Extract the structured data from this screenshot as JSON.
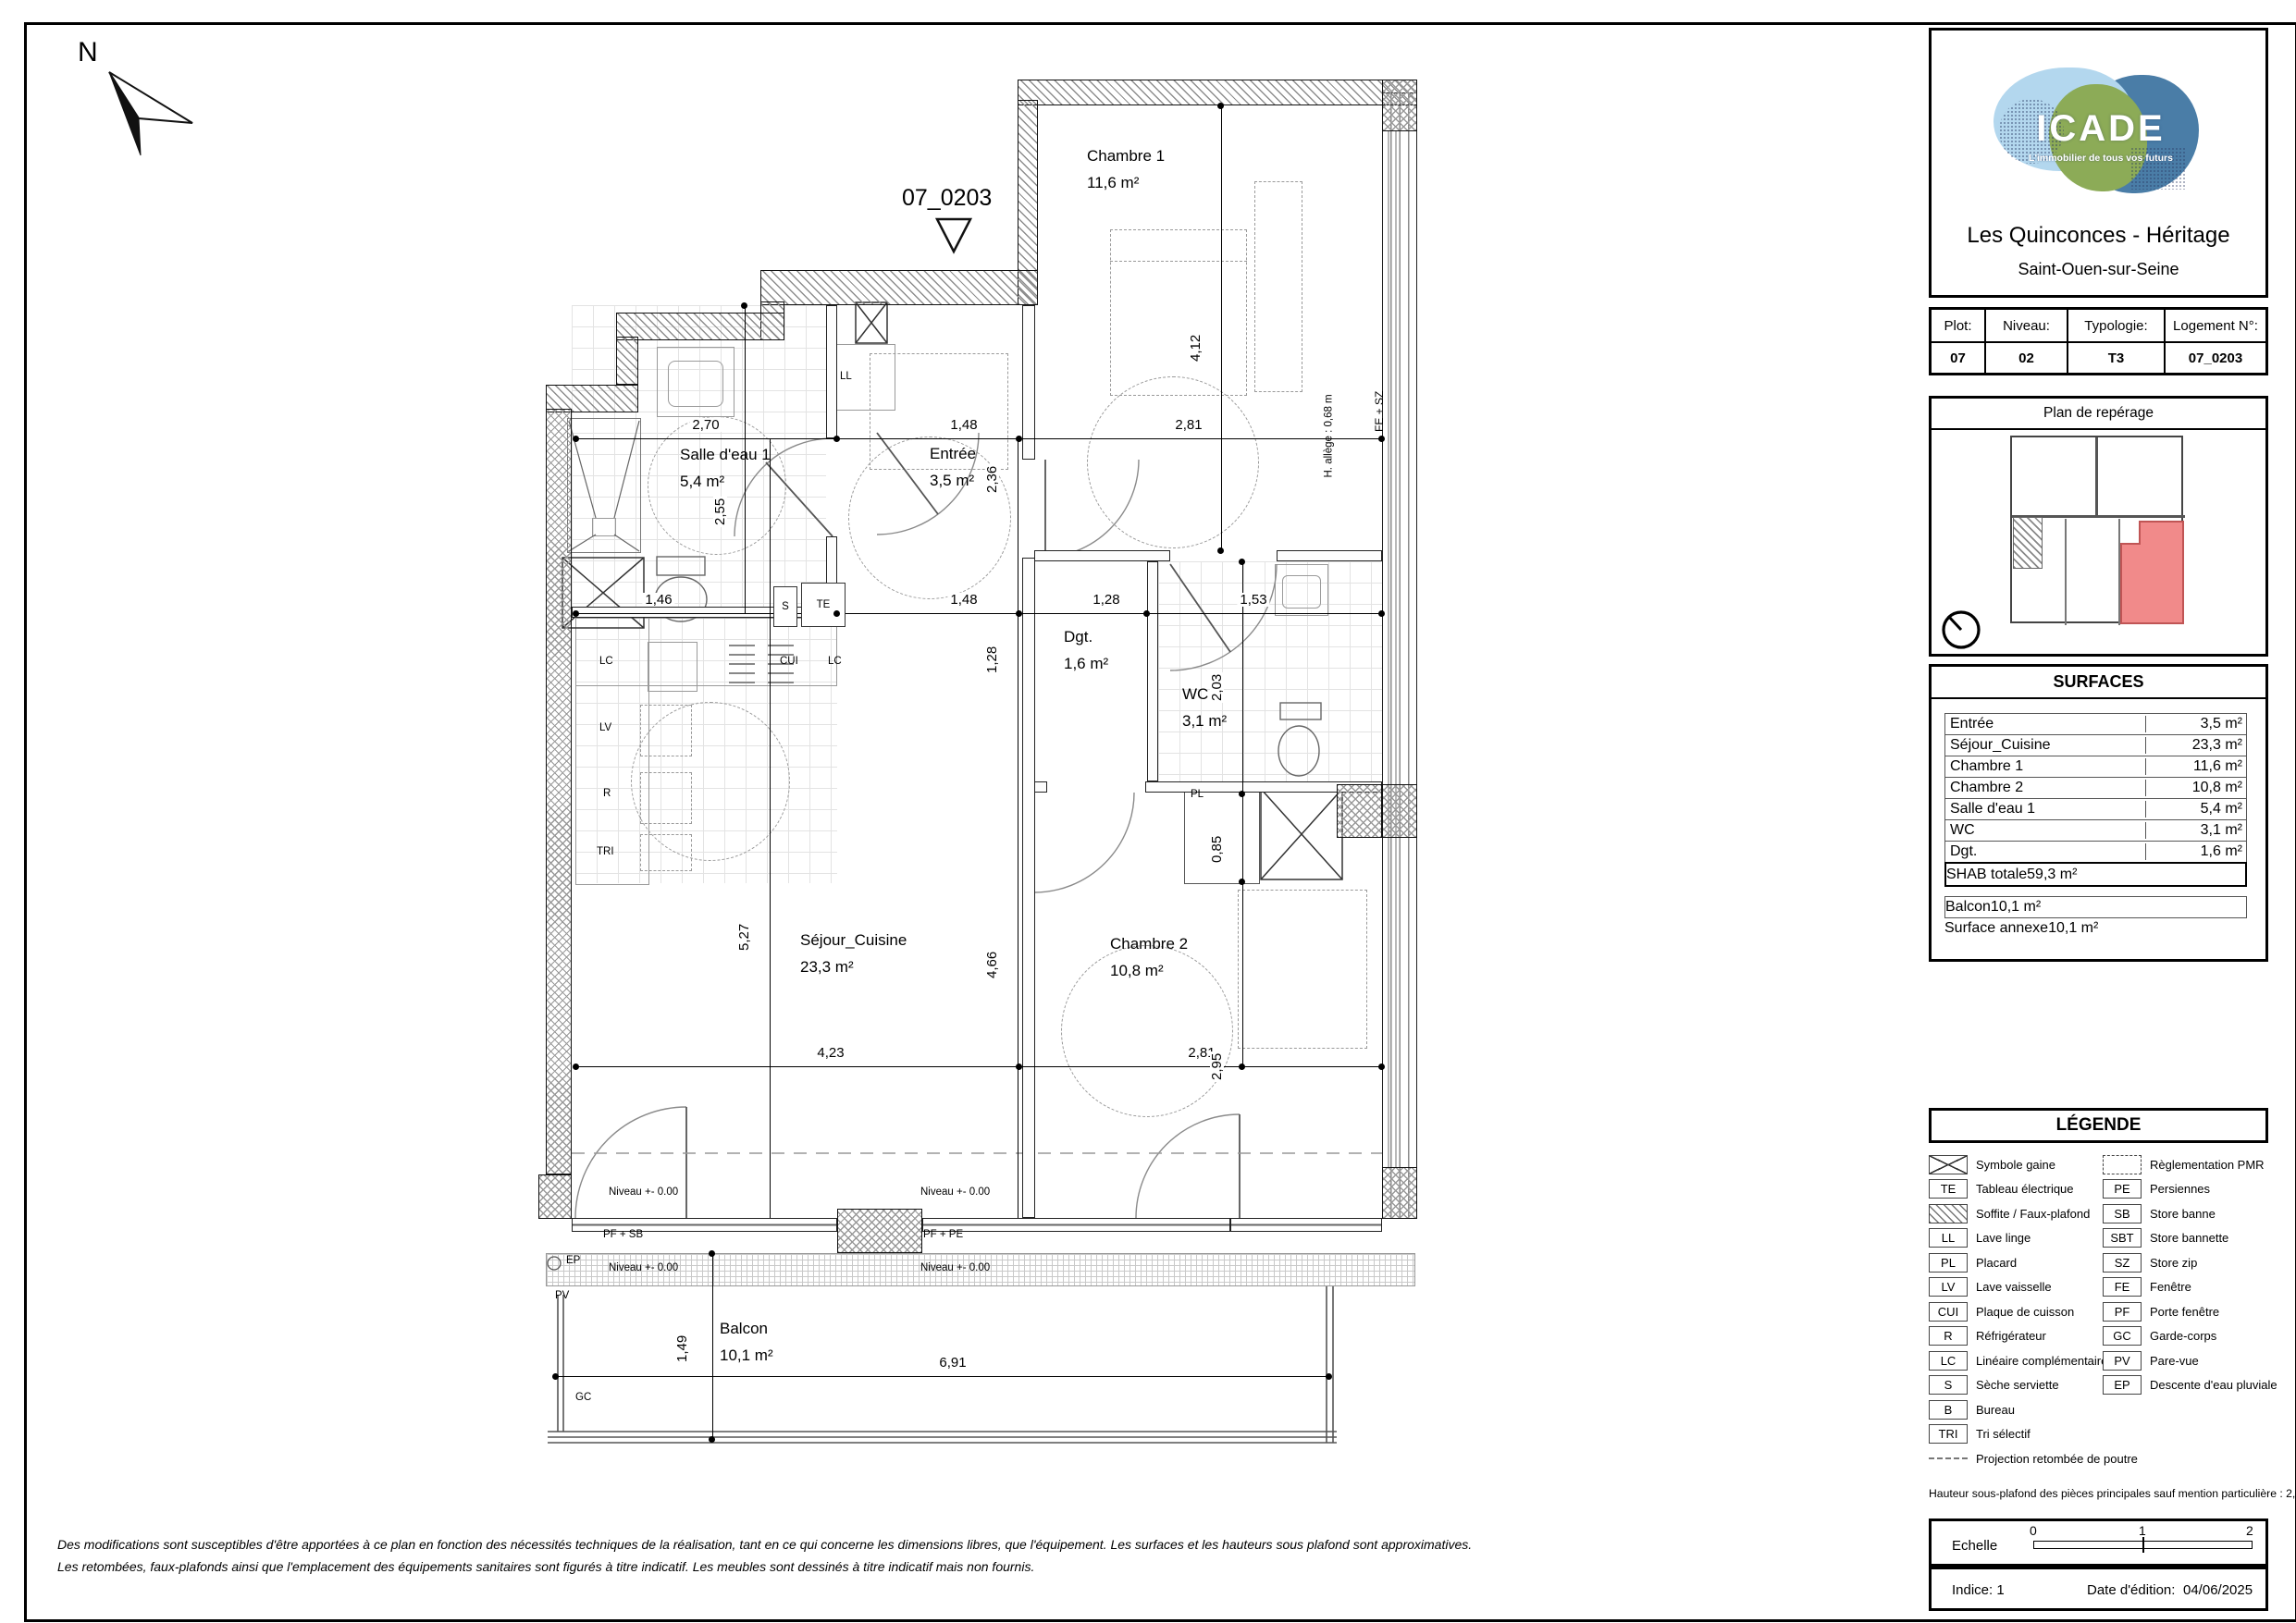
{
  "page": {
    "north_letter": "N",
    "unit_marker": "07_0203",
    "disclaimer_line1": "Des modifications sont susceptibles d'être apportées à ce plan en fonction des nécessités techniques de la réalisation, tant en ce qui concerne les dimensions libres, que l'équipement. Les surfaces et les hauteurs sous plafond sont approximatives.",
    "disclaimer_line2": "Les retombées, faux-plafonds ainsi que l'emplacement des équipements sanitaires sont figurés à titre indicatif. Les meubles sont dessinés à titre indicatif mais non fournis."
  },
  "header": {
    "brand": "ICADE",
    "tagline": "L'immobilier de tous vos futurs",
    "project_title": "Les Quinconces - Héritage",
    "city": "Saint-Ouen-sur-Seine"
  },
  "unit_info": {
    "plot_label": "Plot:",
    "plot_value": "07",
    "level_label": "Niveau:",
    "level_value": "02",
    "type_label": "Typologie:",
    "type_value": "T3",
    "lot_label": "Logement N°:",
    "lot_value": "07_0203"
  },
  "reperage": {
    "title": "Plan de repérage",
    "highlight_color": "#f18a8a"
  },
  "surfaces": {
    "title": "SURFACES",
    "rows": [
      {
        "label": "Entrée",
        "value": "3,5 m²"
      },
      {
        "label": "Séjour_Cuisine",
        "value": "23,3 m²"
      },
      {
        "label": "Chambre 1",
        "value": "11,6 m²"
      },
      {
        "label": "Chambre 2",
        "value": "10,8 m²"
      },
      {
        "label": "Salle d'eau 1",
        "value": "5,4 m²"
      },
      {
        "label": "WC",
        "value": "3,1 m²"
      },
      {
        "label": "Dgt.",
        "value": "1,6 m²"
      }
    ],
    "total": {
      "label": "SHAB totale",
      "value": "59,3 m²"
    },
    "annex_rows": [
      {
        "label": "Balcon",
        "value": "10,1 m²"
      },
      {
        "label": "Surface annexe",
        "value": "10,1 m²"
      }
    ]
  },
  "legend": {
    "title": "LÉGENDE",
    "left": [
      {
        "code": "",
        "label": "Symbole gaine"
      },
      {
        "code": "TE",
        "label": "Tableau électrique"
      },
      {
        "code": "",
        "label": "Soffite / Faux-plafond"
      },
      {
        "code": "LL",
        "label": "Lave linge"
      },
      {
        "code": "PL",
        "label": "Placard"
      },
      {
        "code": "LV",
        "label": "Lave vaisselle"
      },
      {
        "code": "CUI",
        "label": "Plaque de cuisson"
      },
      {
        "code": "R",
        "label": "Réfrigérateur"
      },
      {
        "code": "LC",
        "label": "Linéaire complémentaire"
      },
      {
        "code": "S",
        "label": "Sèche serviette"
      },
      {
        "code": "B",
        "label": "Bureau"
      },
      {
        "code": "TRI",
        "label": "Tri sélectif"
      }
    ],
    "beam_label": "Projection retombée de poutre",
    "right": [
      {
        "code": "",
        "label": "Règlementation PMR"
      },
      {
        "code": "PE",
        "label": "Persiennes"
      },
      {
        "code": "SB",
        "label": "Store banne"
      },
      {
        "code": "SBT",
        "label": "Store bannette"
      },
      {
        "code": "SZ",
        "label": "Store zip"
      },
      {
        "code": "FE",
        "label": "Fenêtre"
      },
      {
        "code": "PF",
        "label": "Porte fenêtre"
      },
      {
        "code": "GC",
        "label": "Garde-corps"
      },
      {
        "code": "PV",
        "label": "Pare-vue"
      },
      {
        "code": "EP",
        "label": "Descente d'eau pluviale"
      }
    ],
    "ceiling_note": "Hauteur sous-plafond des pièces principales sauf mention particulière : 2,50 m"
  },
  "footer": {
    "scale_label": "Echelle",
    "scale_ticks": [
      "0",
      "1",
      "2"
    ],
    "indice": "Indice: 1",
    "date_label": "Date d'édition:",
    "date_value": "04/06/2025"
  },
  "plan": {
    "rooms": {
      "chambre1": {
        "name": "Chambre 1",
        "area": "11,6 m²"
      },
      "entree": {
        "name": "Entrée",
        "area": "3,5 m²"
      },
      "salle_eau": {
        "name": "Salle d'eau 1",
        "area": "5,4 m²"
      },
      "dgt": {
        "name": "Dgt.",
        "area": "1,6 m²"
      },
      "wc": {
        "name": "WC",
        "area": "3,1 m²"
      },
      "sejour": {
        "name": "Séjour_Cuisine",
        "area": "23,3 m²"
      },
      "chambre2": {
        "name": "Chambre 2",
        "area": "10,8 m²"
      },
      "balcon": {
        "name": "Balcon",
        "area": "10,1 m²"
      }
    },
    "dims": {
      "sde_w": "2,70",
      "entree_w": "1,48",
      "ch1_w": "2,81",
      "sde_w2": "1,46",
      "entree_w2": "1,48",
      "dgt_w": "1,28",
      "wc_w": "1,53",
      "sejour_w": "4,23",
      "ch2_w": "2,81",
      "balcon_w": "6,91",
      "sde_h": "2,55",
      "entree_h": "2,36",
      "ch1_h": "4,12",
      "dgt_h": "1,28",
      "wc_h": "2,03",
      "pl_h": "0,85",
      "sejour_h": "5,27",
      "mid_h": "4,66",
      "ch2_h": "2,95",
      "balcon_h": "1,49"
    },
    "annotations": {
      "ll": "LL",
      "s": "S",
      "te": "TE",
      "lc": "LC",
      "cui": "CUI",
      "lv": "LV",
      "r": "R",
      "tri": "TRI",
      "pl": "PL",
      "ep": "EP",
      "pv": "PV",
      "gc": "GC",
      "pf_sb": "PF + SB",
      "pf_pe": "PF + PE",
      "fe_sz": "FE + SZ",
      "h_allege": "H. allège : 0,68 m",
      "niveau": "Niveau +- 0.00"
    }
  }
}
